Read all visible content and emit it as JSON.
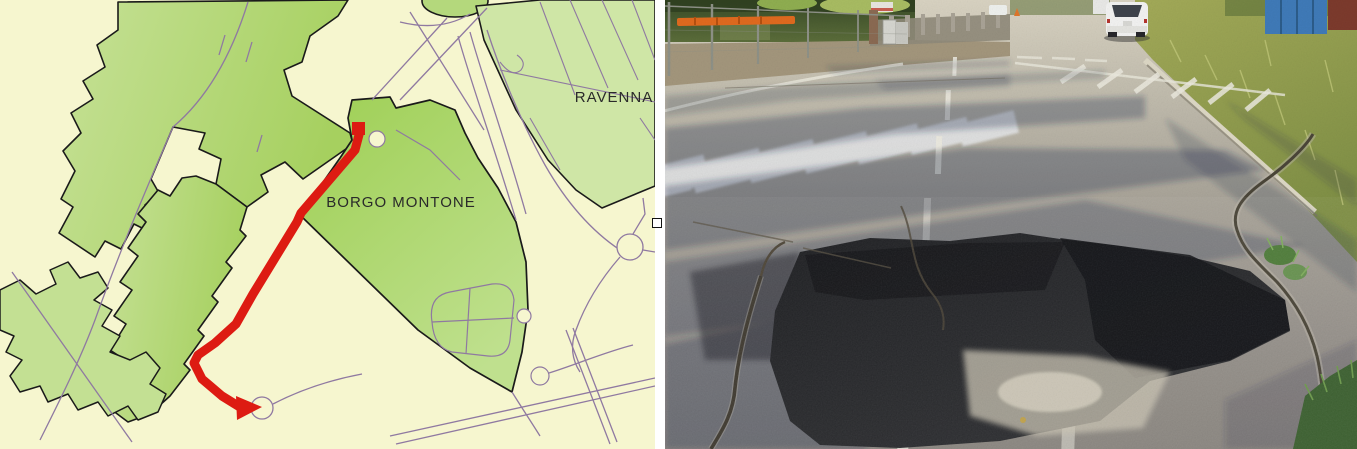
{
  "map": {
    "labels": {
      "city": "RAVENNA",
      "district": "BORGO MONTONE"
    },
    "colors": {
      "background": "#f6f6cf",
      "urban_green": "#a8d164",
      "urban_green_light": "#c9e49c",
      "block_green": "#cfe6a6",
      "road_line": "#8f79a1",
      "boundary_black": "#1a1a1a",
      "route_red": "#dd1b12"
    }
  },
  "photo": {
    "colors": {
      "road_sunlit": "#d8d2c0",
      "road_foreground": "#8e8a82",
      "shadow_blue": "#26304e",
      "patch_asphalt": "#1d1e21",
      "marking_white": "#eceadf",
      "grass_verge": "#97a051",
      "hedge_green": "#46572e",
      "container_blue": "#3f7ab8",
      "barrier_orange": "#e06a1e",
      "car_white": "#f2f2f1"
    }
  }
}
